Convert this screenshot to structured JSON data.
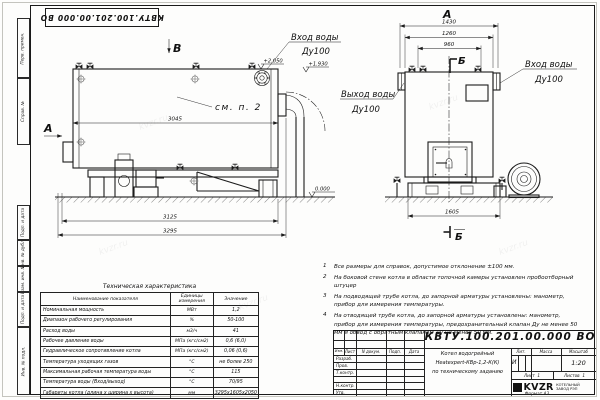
{
  "page": {
    "format_label": "Формат А3",
    "watermark": "kvzr.ru"
  },
  "stamp_top": {
    "text": "КВТУ.100.201.00.000 ВО"
  },
  "frame_stamps": [
    "Перв. примен.",
    "Справ. №",
    "Подп. и дата",
    "Инв. № дубл.",
    "Взам. инв. №",
    "Подп. и дата",
    "Инв. № подл."
  ],
  "side_view": {
    "view_b": "В",
    "view_a": "А",
    "callout": "см. п. 2",
    "dim_shell": "3045",
    "dim_frame": "3125",
    "dim_total": "3295",
    "elev_inlet": "+2.050",
    "elev_shell": "+1.930",
    "elev_ground": "0.000",
    "inlet_line1": "Вход воды",
    "inlet_line2": "Ду100"
  },
  "front_view": {
    "title": "А",
    "section_top": "Б",
    "section_bottom": "Б",
    "dim_1": "1430",
    "dim_2": "1260",
    "dim_3": "960",
    "dim_base": "1605",
    "outlet_line1": "Выход воды",
    "outlet_line2": "Ду100",
    "inlet_line1": "Вход воды",
    "inlet_line2": "Ду100"
  },
  "notes": [
    {
      "num": "1",
      "text": "Все размеры для справок, допустимое отклонение ±100 мм."
    },
    {
      "num": "2",
      "text": "На боковой стене котла в области топочной камеры установлен пробоотборный штуцер"
    },
    {
      "num": "3",
      "text": "На подводящей трубе котла, до запорной арматуры установлены: манометр, прибор для измерения температуры."
    },
    {
      "num": "4",
      "text": "На отводящей трубе котла, до запорной арматуры установлены: манометр, прибор для измерения температуры, предохранительный клапан Ду не менее 50 мм и обвод с обратным клапаном Ду не менее 50 мм."
    }
  ],
  "spec_table": {
    "title": "Техническая характеристика",
    "headers": [
      "Наименование показателя",
      "Единицы измерения",
      "Значение"
    ],
    "rows": [
      [
        "Номинальная мощность",
        "МВт",
        "1,2"
      ],
      [
        "Диапазон рабочего регулирования",
        "%",
        "50-100"
      ],
      [
        "Расход воды",
        "м3/ч",
        "41"
      ],
      [
        "Рабочее давление воды",
        "МПа (кгс/см2)",
        "0,6 (6,0)"
      ],
      [
        "Гидравлическое сопротивление котла",
        "МПа (кгс/см2)",
        "0,06 (0,6)"
      ],
      [
        "Температура уходящих газов",
        "°С",
        "не более 250"
      ],
      [
        "Максимальная рабочая температура воды",
        "°С",
        "115"
      ],
      [
        "Температура воды (Вход/выход)",
        "°С",
        "70/95"
      ],
      [
        "Габариты котла (длина х ширина х высота)",
        "мм",
        "3295х1605х2050"
      ]
    ]
  },
  "title_block": {
    "doc_number": "КВТУ.100.201.00.000 ВО",
    "header_cells": [
      "Изм.",
      "Лист",
      "N докум.",
      "Подп.",
      "Дата"
    ],
    "row_labels": [
      "Разраб.",
      "Пров.",
      "Т.контр.",
      "",
      "Н.контр.",
      "Утв."
    ],
    "name_line1": "Котел водогрейный",
    "name_line2": "Heatexpert-КВр-1,2-К(К)",
    "name_line3": "по техническому заданию",
    "lit_header": "Лит.",
    "mass_header": "Масса",
    "scale_header": "Масштаб",
    "lit_value": "И",
    "scale_value": "1:20",
    "sheet_label": "Лист",
    "sheet_value": "1",
    "sheets_label": "Листов",
    "sheets_value": "1",
    "logo_text": "KVZR",
    "company_line1": "КОТЕЛЬНЫЙ",
    "company_line2": "ЗАВОД РЭП"
  }
}
